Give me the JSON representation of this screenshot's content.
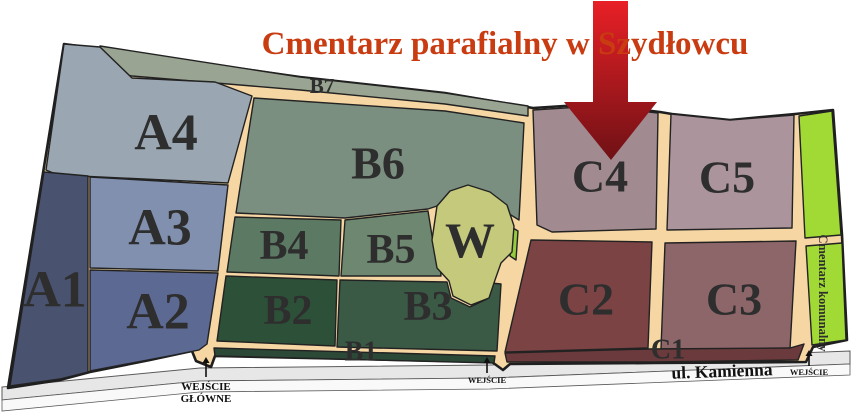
{
  "title": {
    "text": "Cmentarz parafialny w Szydłowcu",
    "color": "#c93b10"
  },
  "map": {
    "background": "#ffffff",
    "path_color": "#f6d7a4",
    "outline_stroke": "#1f1f1f",
    "outline_points": "64,44 300,77 445,93 533,108 595,104 660,112 672,114 730,120 795,114 833,110 842,235 847,340 813,347 806,362 655,363 510,364 503,370 492,362 215,356 211,367 196,361 192,351 150,360 90,372 60,380 8,388",
    "road": {
      "label": "ul. Kamienna",
      "label_x": 722,
      "label_y": 371,
      "label_size": 17.5,
      "label_rotate": -2,
      "label_color": "#111111",
      "upper_points": "2,387 200,368 490,365 850,351 850,364 490,378 200,381 2,400",
      "lower_points": "2,400 200,381 490,378 850,364 850,375 490,389 200,392 2,411",
      "upper_fill": "#e7e7e7",
      "lower_fill": "#f9f9f9",
      "stroke": "#5a5a5a"
    },
    "regions": [
      {
        "id": "b7-strip",
        "points": "100,46 300,77 445,93 528,106 528,116 445,104 300,90 132,76 104,70",
        "fill": "#99a492"
      },
      {
        "id": "a4",
        "points": "64,44 100,47 132,78 215,82 252,96 228,183 58,175 46,170",
        "fill": "#9aa6b2"
      },
      {
        "id": "a3",
        "points": "90,177 228,185 218,271 90,268",
        "fill": "#8090ae"
      },
      {
        "id": "a2",
        "points": "90,270 218,273 207,344 199,350 174,355 90,371",
        "fill": "#5c6992"
      },
      {
        "id": "a1",
        "points": "44,172 88,176 88,372 60,379 10,386",
        "fill": "#49526e"
      },
      {
        "id": "b6",
        "points": "254,98 445,111 524,123 519,220 506,212 488,196 467,189 449,195 437,206 428,209 345,218 236,213",
        "fill": "#7b8f80"
      },
      {
        "id": "b4",
        "points": "235,217 341,220 339,276 227,272",
        "fill": "#5c7a63"
      },
      {
        "id": "b5",
        "points": "345,220 428,211 433,242 440,261 441,276 341,276",
        "fill": "#6e8770"
      },
      {
        "id": "b2",
        "points": "226,276 337,280 335,346 217,341",
        "fill": "#2d5138"
      },
      {
        "id": "b3",
        "points": "340,280 447,282 451,298 470,307 487,299 491,283 501,284 497,351 337,347",
        "fill": "#3a5a46"
      },
      {
        "id": "b1-strip",
        "points": "214,348 495,356 494,363 215,356",
        "fill": "#2c4837"
      },
      {
        "id": "w-sliver",
        "points": "513,228 518,231 516,260 510,256",
        "fill": "#94cc3c"
      },
      {
        "id": "w-chapel",
        "points": "437,206 450,191 468,185 490,192 507,205 514,226 512,252 501,263 495,280 489,298 471,305 453,296 449,281 437,268 432,240",
        "fill": "#c5c97b"
      },
      {
        "id": "c4",
        "points": "533,110 595,106 658,113 656,229 552,232 537,225",
        "fill": "#a28a91"
      },
      {
        "id": "c5",
        "points": "671,114 730,120 794,115 792,228 667,230",
        "fill": "#ab949b"
      },
      {
        "id": "c2",
        "points": "531,240 652,242 648,348 505,352",
        "fill": "#7b4344"
      },
      {
        "id": "c3",
        "points": "665,243 796,241 790,349 661,349",
        "fill": "#8d666a"
      },
      {
        "id": "c1-strip",
        "points": "505,353 648,349 790,348 804,344 798,360 655,362 507,362",
        "fill": "#6b3a3c"
      },
      {
        "id": "communal-top",
        "points": "799,116 832,111 841,235 805,238",
        "fill": "#a2da35"
      },
      {
        "id": "communal-bottom",
        "points": "806,246 842,243 846,340 812,345",
        "fill": "#a2da35"
      }
    ],
    "labels": [
      {
        "id": "a4",
        "text": "A4",
        "x": 166,
        "y": 133,
        "size": 52
      },
      {
        "id": "a3",
        "text": "A3",
        "x": 160,
        "y": 228,
        "size": 52
      },
      {
        "id": "a2",
        "text": "A2",
        "x": 158,
        "y": 312,
        "size": 52
      },
      {
        "id": "a1",
        "text": "A1",
        "x": 55,
        "y": 290,
        "size": 52
      },
      {
        "id": "b6",
        "text": "B6",
        "x": 378,
        "y": 163,
        "size": 46
      },
      {
        "id": "b7",
        "text": "B7",
        "x": 322,
        "y": 86,
        "size": 21
      },
      {
        "id": "b4",
        "text": "B4",
        "x": 284,
        "y": 246,
        "size": 42
      },
      {
        "id": "b5",
        "text": "B5",
        "x": 391,
        "y": 250,
        "size": 42
      },
      {
        "id": "b2",
        "text": "B2",
        "x": 288,
        "y": 311,
        "size": 42
      },
      {
        "id": "b3",
        "text": "B3",
        "x": 428,
        "y": 307,
        "size": 42
      },
      {
        "id": "w",
        "text": "W",
        "x": 470,
        "y": 240,
        "size": 50
      },
      {
        "id": "b1",
        "text": "B1",
        "x": 361,
        "y": 352,
        "size": 28
      },
      {
        "id": "c4",
        "text": "C4",
        "x": 600,
        "y": 176,
        "size": 46
      },
      {
        "id": "c5",
        "text": "C5",
        "x": 727,
        "y": 177,
        "size": 46
      },
      {
        "id": "c2",
        "text": "C2",
        "x": 586,
        "y": 299,
        "size": 46
      },
      {
        "id": "c3",
        "text": "C3",
        "x": 734,
        "y": 299,
        "size": 46
      },
      {
        "id": "c1",
        "text": "C1",
        "x": 668,
        "y": 350,
        "size": 28
      },
      {
        "id": "communal",
        "text": "Cmentarz komunalny",
        "x": 823,
        "y": 293,
        "size": 12.5,
        "rotate": 90
      }
    ],
    "label_color": "#2e2e2e",
    "pointer_arrow": {
      "points": "593,1 628,1 628,102 657,102 611,160 564,102 593,102",
      "color_top": "#e82026",
      "color_bottom": "#6f1115"
    },
    "entrances": [
      {
        "id": "main-entrance",
        "lines": [
          "WEJŚCIE",
          "GŁÓWNE"
        ],
        "x": 206,
        "arrow_tail_y": 377,
        "arrow_tip_y": 357,
        "text_y": 387,
        "line_h": 12,
        "size": 11
      },
      {
        "id": "middle-entrance",
        "lines": [
          "WEJŚCIE"
        ],
        "x": 487,
        "arrow_tail_y": 373,
        "arrow_tip_y": 357,
        "text_y": 380,
        "line_h": 10,
        "size": 8.5
      },
      {
        "id": "right-entrance",
        "lines": [
          "WEJŚCIE"
        ],
        "x": 809,
        "arrow_tail_y": 366,
        "arrow_tip_y": 350,
        "text_y": 372,
        "line_h": 10,
        "size": 8.5
      }
    ],
    "entrance_color": "#111111"
  }
}
